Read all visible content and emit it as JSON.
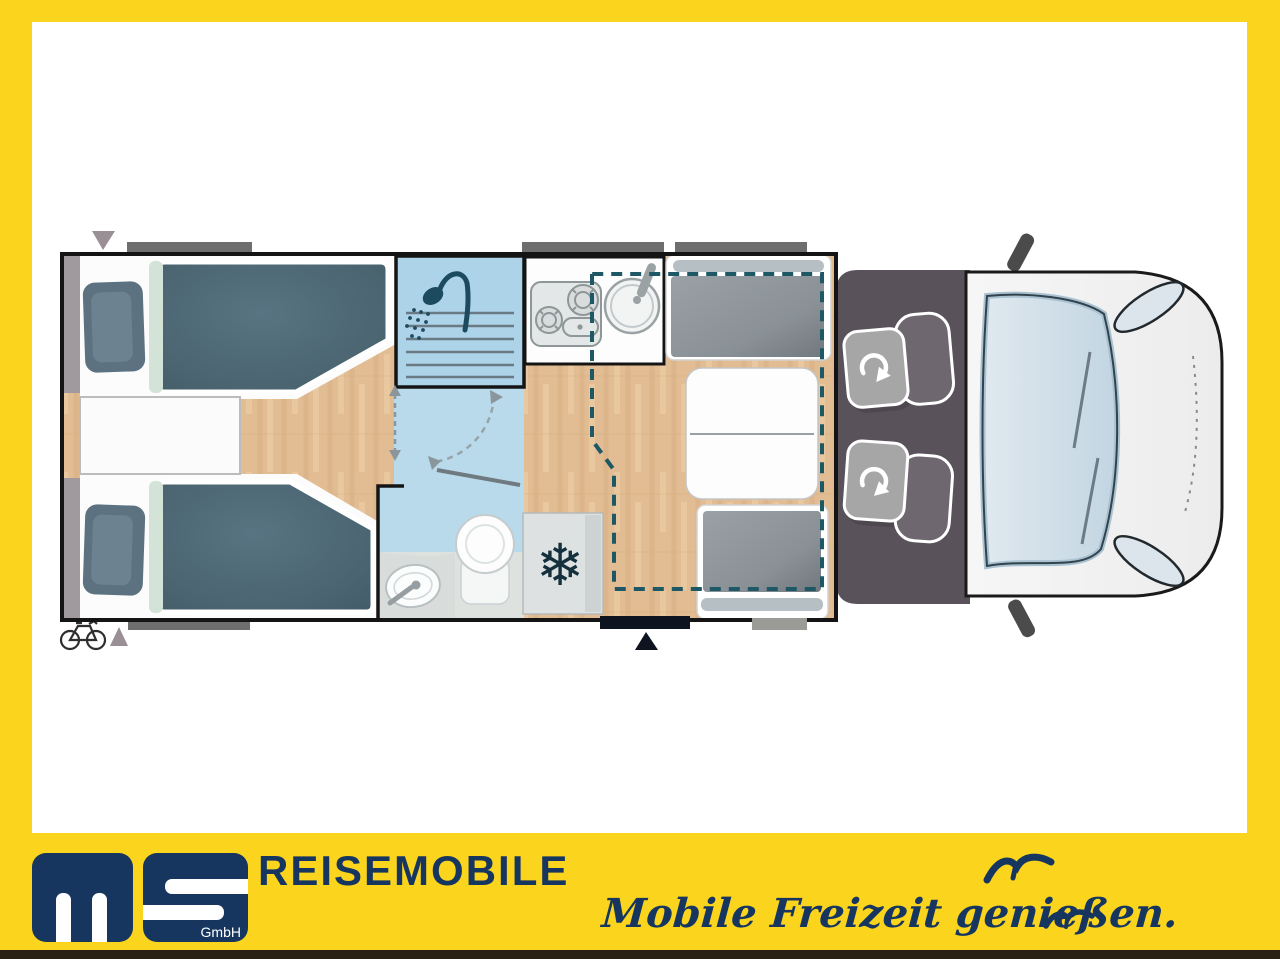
{
  "branding": {
    "logo": {
      "m": "M",
      "s": "S",
      "gmbh": "GmbH",
      "navy": "#17365F"
    },
    "title": "REISEMOBILE",
    "tagline": "Mobile Freizeit genießen."
  },
  "frame": {
    "yellow": "#FBD41E",
    "bottom_strip": "#2A2115",
    "canvas": "#FFFFFF"
  },
  "floorplan": {
    "colors": {
      "wall": "#141414",
      "wood_floor": "#E2BC92",
      "bathroom_blue": "#B9DAEB",
      "shower_blue": "#ACD3E8",
      "mattress": "#4A6470",
      "pillow": "#5C7280",
      "headboard": "#D4E3D8",
      "bench_cushion": "#8E959A",
      "cab_floor": "#59525B",
      "vehicle_body": "#F4F4F4",
      "windshield": "#CFDFEA",
      "drop_down_bed_dash": "#1D5864",
      "exterior_bar": "#6E6E6E",
      "marker_gray": "#9B8F96",
      "entry_door": "#0D1420"
    },
    "features": [
      "twin-single-bed-rear-left",
      "twin-single-bed-rear-right",
      "nightstand",
      "wardrobe-strips",
      "shower-cabin",
      "toilet",
      "washbasin",
      "bathroom-swing-door",
      "kitchen-stove",
      "kitchen-sink",
      "refrigerator",
      "dinette-rear-bench",
      "dinette-front-bench",
      "dinette-table",
      "drop-down-bed-outline",
      "entry-door",
      "entry-step",
      "cab-swivel-seat-driver",
      "cab-swivel-seat-passenger",
      "vehicle-front",
      "bike-rack-marker"
    ]
  }
}
